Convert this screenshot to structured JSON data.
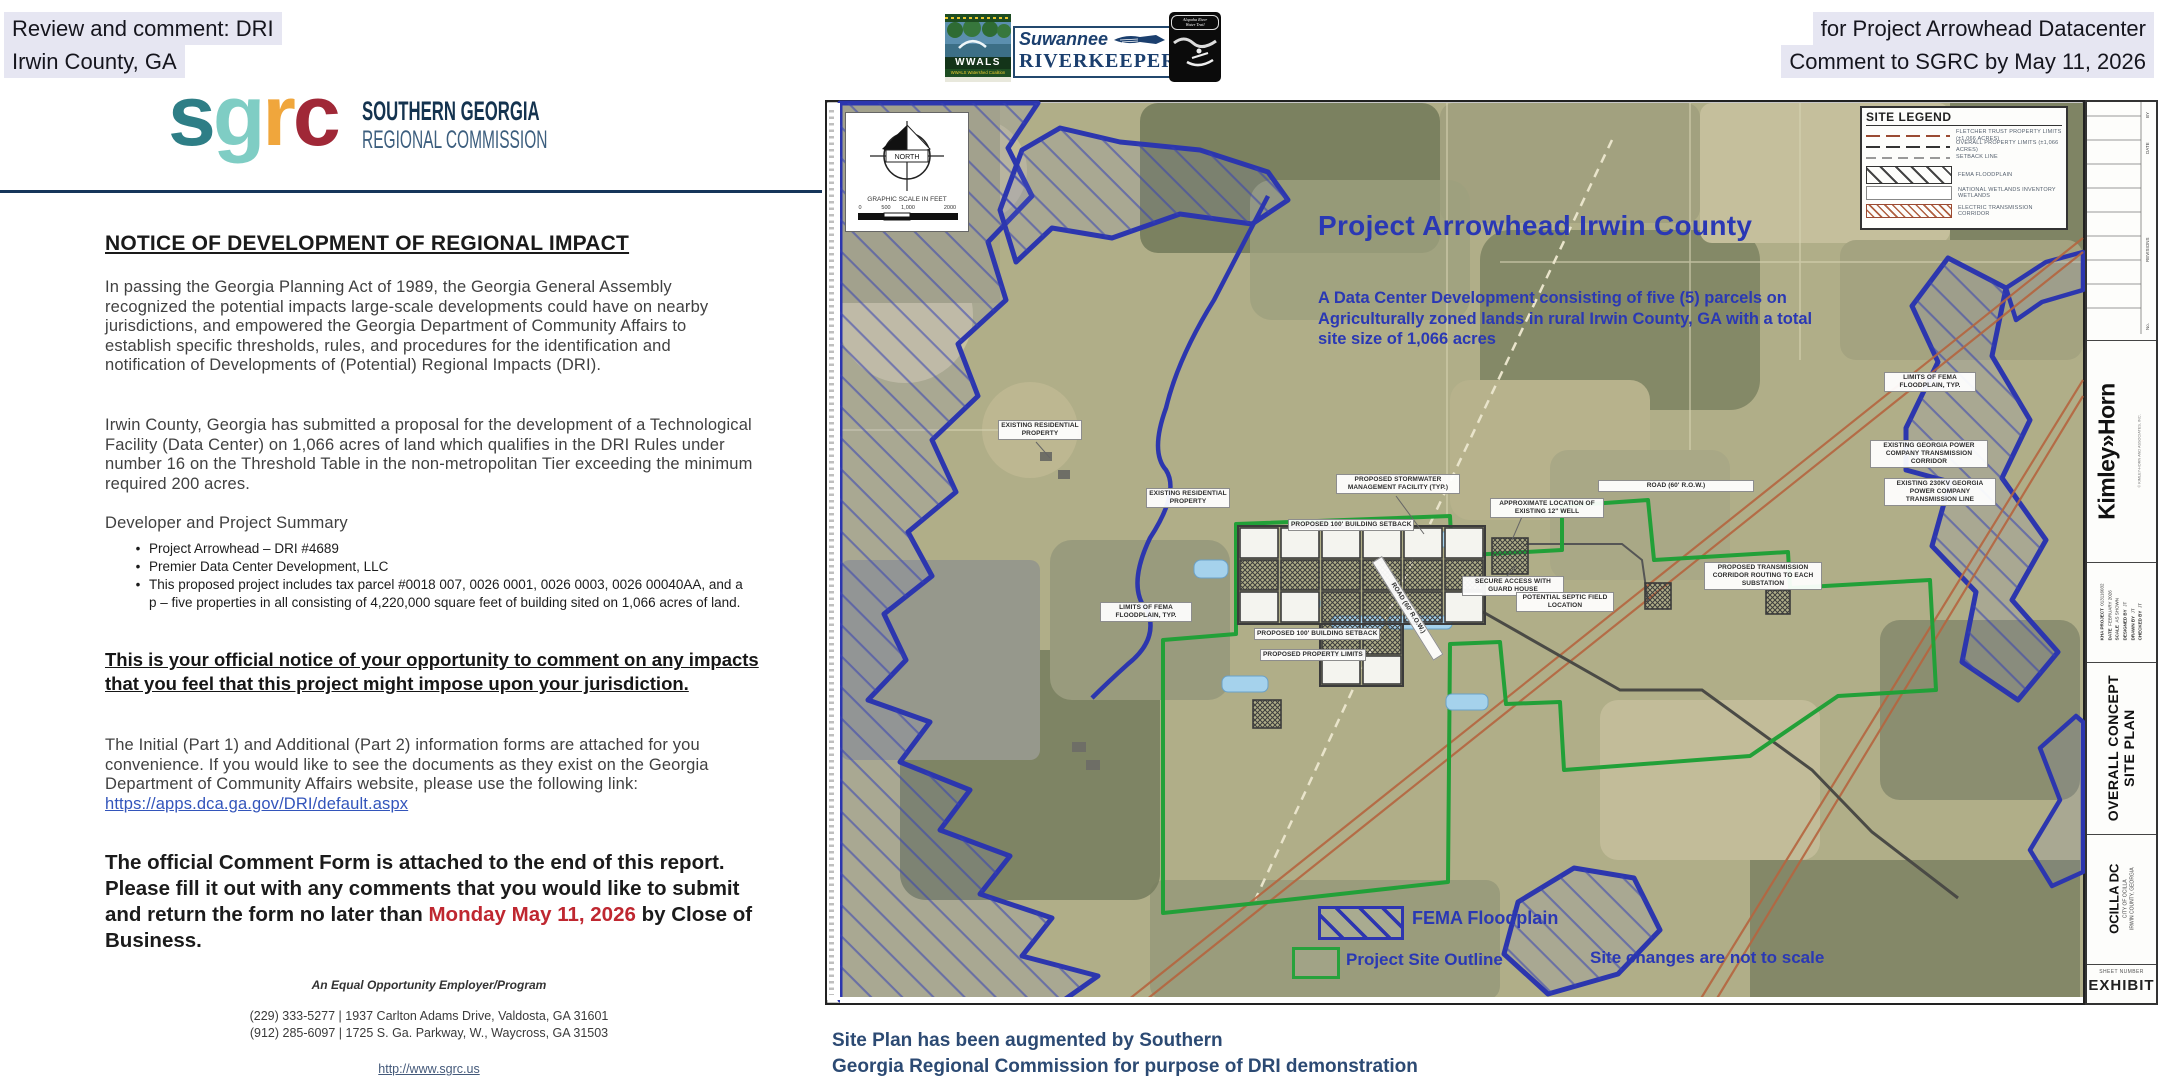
{
  "palette": {
    "highlight": "#e6e6f2",
    "map_blue": "#2a38b4",
    "site_green": "#22a038",
    "date_red": "#bf2730",
    "navy": "#16355a"
  },
  "header": {
    "left_line1": "Review and comment: DRI",
    "left_line2": "Irwin County, GA",
    "right_line1": "for Project Arrowhead Datacenter",
    "right_line2": "Comment to SGRC by May 11, 2026"
  },
  "banner": {
    "wwals_name": "WWALS",
    "wwals_footer": "WWALS Watershed Coalition",
    "suwannee": "Suwannee",
    "riverkeeper": "RIVERKEEPER",
    "reg_mark": "®",
    "badge_line1": "Alapaha River",
    "badge_line2": "Water Trail"
  },
  "sgrc": {
    "letter_s": "s",
    "letter_g": "g",
    "letter_r": "r",
    "letter_c": "c",
    "name_line1": "SOUTHERN GEORGIA",
    "name_line2": "REGIONAL COMMISSION"
  },
  "document": {
    "title": "NOTICE OF DEVELOPMENT OF REGIONAL IMPACT",
    "para1": "In passing the Georgia Planning Act of 1989, the Georgia General Assembly recognized the potential impacts large-scale developments could have on nearby jurisdictions, and empowered the Georgia Department of Community Affairs to establish specific thresholds, rules, and procedures for the identification and notification of Developments of (Potential) Regional Impacts (DRI).",
    "para2": "Irwin County, Georgia has submitted a proposal for the development of a Technological Facility (Data Center) on 1,066 acres of land which qualifies in the DRI Rules under number 16 on the Threshold Table in the non-metropolitan Tier exceeding the minimum required 200 acres.",
    "summary_heading": "Developer and Project Summary",
    "bullet1": "Project Arrowhead – DRI #4689",
    "bullet2": "Premier Data Center Development, LLC",
    "bullet3": "This proposed project includes tax parcel #0018 007, 0026 0001, 0026 0003, 0026 00040AA, and a p – five properties in all consisting of 4,220,000 square feet of building sited on 1,066 acres of land.",
    "notice": "This is your official notice of your opportunity to comment on any impacts that you feel that this project might impose upon your jurisdiction.",
    "forms_text": "The Initial (Part 1) and Additional (Part 2) information forms are attached for you convenience.  If you would like to see the documents as they exist on the Georgia Department of Community Affairs website, please use the following link:",
    "forms_link": "https://apps.dca.ga.gov/DRI/default.aspx",
    "comment_pre": "The official Comment Form is attached to the end of this report.  Please fill it out with any comments that you would like to submit and return the form no later than",
    "comment_date": "Monday May 11, 2026",
    "comment_post": "by Close of Business.",
    "eoe": "An Equal Opportunity Employer/Program",
    "contact1": "(229) 333-5277 | 1937 Carlton Adams Drive, Valdosta, GA 31601",
    "contact2": "(912) 285-6097 | 1725 S. Ga. Parkway, W., Waycross, GA 31503",
    "website": "http://www.sgrc.us"
  },
  "map": {
    "title": "Project Arrowhead Irwin County",
    "subtitle": "A Data Center Development consisting of five (5) parcels on Agriculturally zoned lands in rural Irwin County, GA with a total site size of 1,066 acres",
    "north_label": "NORTH",
    "scale_title": "GRAPHIC SCALE IN FEET",
    "scale_t0": "0",
    "scale_t1": "500",
    "scale_t2": "1,000",
    "scale_t3": "2000",
    "site_legend_title": "SITE LEGEND",
    "site_legend_items": [
      "FLETCHER TRUST PROPERTY LIMITS (±1,066 ACRES)",
      "OVERALL PROPERTY LIMITS (±1,066 ACRES)",
      "SETBACK LINE",
      "FEMA FLOODPLAIN",
      "NATIONAL WETLANDS INVENTORY WETLANDS",
      "ELECTRIC TRANSMISSION CORRIDOR"
    ],
    "fema_label": "FEMA Floodplain",
    "site_outline_label": "Project Site Outline",
    "not_to_scale": "Site changes are not to scale",
    "callouts": [
      "EXISTING RESIDENTIAL PROPERTY",
      "EXISTING RESIDENTIAL PROPERTY",
      "PROPOSED STORMWATER MANAGEMENT FACILITY (TYP.)",
      "PROPOSED 100' BUILDING SETBACK",
      "APPROXIMATE LOCATION OF EXISTING 12\" WELL",
      "SECURE ACCESS WITH GUARD HOUSE",
      "PROPOSED 100' BUILDING SETBACK",
      "PROPOSED PROPERTY LIMITS",
      "LIMITS OF FEMA FLOODPLAIN, TYP.",
      "LIMITS OF FEMA FLOODPLAIN, TYP.",
      "EXISTING GEORGIA POWER COMPANY TRANSMISSION CORRIDOR",
      "EXISTING 230KV GEORGIA POWER COMPANY TRANSMISSION LINE",
      "PROPOSED TRANSMISSION CORRIDOR ROUTING TO EACH SUBSTATION",
      "POTENTIAL SEPTIC FIELD LOCATION",
      "ROAD (60' R.O.W.)",
      "ROAD (60' R.O.W.)"
    ],
    "caption1": "Site Plan has been augmented by Southern",
    "caption2": "Georgia Regional Commission for purpose of DRI demonstration"
  },
  "titleblock": {
    "firm": "Kimley»Horn",
    "firm_note": "© KIMLEY-HORN AND ASSOCIATES, INC.",
    "rev_no": "No.",
    "rev_revisions": "REVISIONS",
    "rev_date": "DATE",
    "rev_by": "BY",
    "info": [
      {
        "label": "KHA PROJECT",
        "value": "013116032"
      },
      {
        "label": "DATE",
        "value": "FEBRUARY 2026"
      },
      {
        "label": "SCALE",
        "value": "AS SHOWN"
      },
      {
        "label": "DESIGNED BY",
        "value": "JT"
      },
      {
        "label": "DRAWN BY",
        "value": "JT"
      },
      {
        "label": "CHECKED BY",
        "value": "JT"
      }
    ],
    "sheet_title1": "OVERALL CONCEPT",
    "sheet_title2": "SITE PLAN",
    "project": "OCILLA DC",
    "project_sub1": "CITY OF OCILLA",
    "project_sub2": "IRWIN COUNTY, GEORGIA",
    "sheet_number_label": "SHEET NUMBER",
    "sheet_number": "EXHIBIT"
  }
}
